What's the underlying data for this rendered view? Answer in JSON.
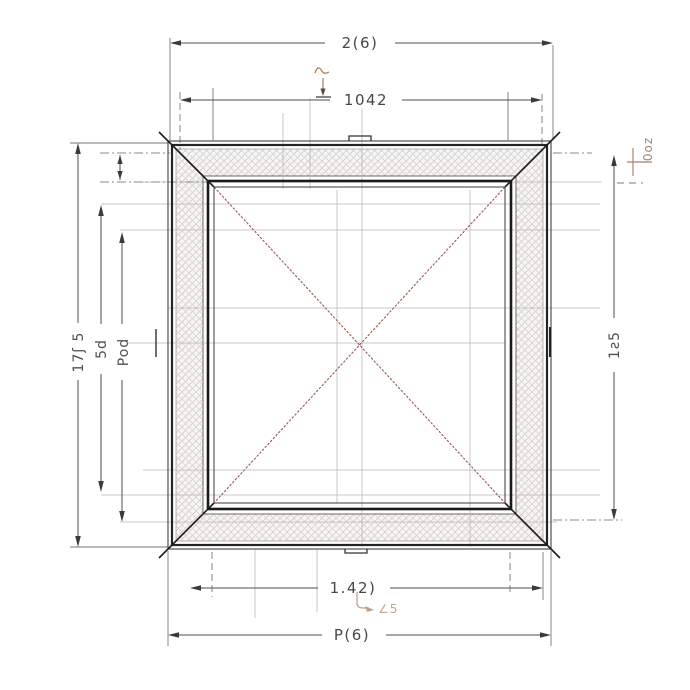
{
  "drawing_type": "architectural plan drawing of square frame with hatched border and crossed diagonals",
  "dims": {
    "top_outer": "2(6)",
    "top_inner": "1042",
    "bottom_inner": "1.42)",
    "bottom_outer": "P(6)",
    "left_outer": "17ʃ 5",
    "left_mid": "5d",
    "left_inner": "Pod",
    "right_outer": "1ƨ5",
    "note_top_right": "0oz",
    "note_bottom": "∠5"
  },
  "colors": {
    "frame_dark": "#242424",
    "frame_mid": "#3f3f3f",
    "construction": "#b9b9b9",
    "dim_line": "#4e4e4e",
    "diagonal_red": "#9a5a50",
    "annotation_brown": "#ab8468",
    "hatch_line": "#cfcccc",
    "background": "#ffffff"
  }
}
